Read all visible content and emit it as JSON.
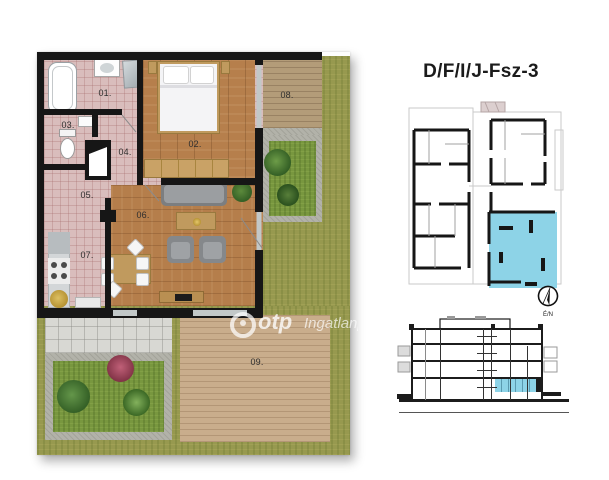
{
  "title": "D/F/I/J-Fsz-3",
  "compass": {
    "label": "É/N"
  },
  "watermark": {
    "brand": "otp",
    "suffix": "Ingatlanpo"
  },
  "floorplan": {
    "rooms": [
      {
        "number": "01."
      },
      {
        "number": "02."
      },
      {
        "number": "03."
      },
      {
        "number": "04."
      },
      {
        "number": "05."
      },
      {
        "number": "06."
      },
      {
        "number": "07."
      },
      {
        "number": "08."
      },
      {
        "number": "09."
      }
    ]
  },
  "colors": {
    "highlight_unit": "#8dd3e7",
    "wall": "#161616",
    "tile_floor": "#d9bdbc",
    "wood_floor": "#b67f4c",
    "terrace_deck": "#b39c79",
    "garden_deck": "#c9ad8c",
    "grass": "#97994f",
    "garden_grass": "#78973f",
    "paving": "#d8d8d3",
    "gravel": "#b2b2a9"
  }
}
